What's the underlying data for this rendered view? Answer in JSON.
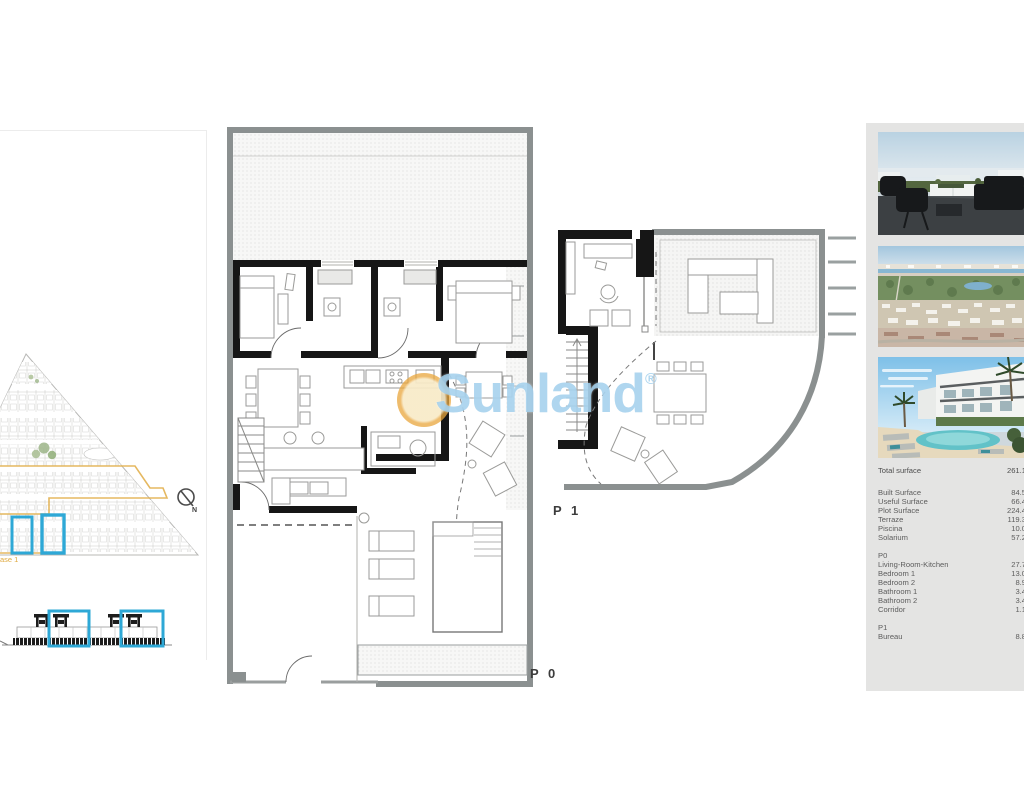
{
  "watermark": {
    "brand": "Sunland",
    "registered": "®"
  },
  "site_plan": {
    "phase_label": "ase 1",
    "compass_label": "N",
    "highlight_color": "#2ea8d6",
    "phase_color": "#e2b04f"
  },
  "plans": {
    "ground_floor_label": "P 0",
    "first_floor_label": "P 1"
  },
  "details_panel": {
    "photos": [
      {
        "name": "solarium-terrace-render"
      },
      {
        "name": "aerial-coast-view"
      },
      {
        "name": "residential-pool-render"
      }
    ],
    "summary": [
      {
        "label": "Total surface",
        "value": "261.1"
      }
    ],
    "surfaces": [
      {
        "label": "Built Surface",
        "value": "84.5"
      },
      {
        "label": "Useful Surface",
        "value": "66.4"
      },
      {
        "label": "Plot Surface",
        "value": "224.4"
      },
      {
        "label": "Terraze",
        "value": "119.3"
      },
      {
        "label": "Piscina",
        "value": "10.0"
      },
      {
        "label": "Solarium",
        "value": "57.2"
      }
    ],
    "p0": {
      "header": "P0",
      "rows": [
        {
          "label": "Living-Room-Kitchen",
          "value": "27.7"
        },
        {
          "label": "Bedroom 1",
          "value": "13.0"
        },
        {
          "label": "Bedroom 2",
          "value": "8.9"
        },
        {
          "label": "Bathroom 1",
          "value": "3.4"
        },
        {
          "label": "Bathroom 2",
          "value": "3.4"
        },
        {
          "label": "Corridor",
          "value": "1.1"
        }
      ]
    },
    "p1": {
      "header": "P1",
      "rows": [
        {
          "label": "Bureau",
          "value": "8.8"
        }
      ]
    }
  }
}
